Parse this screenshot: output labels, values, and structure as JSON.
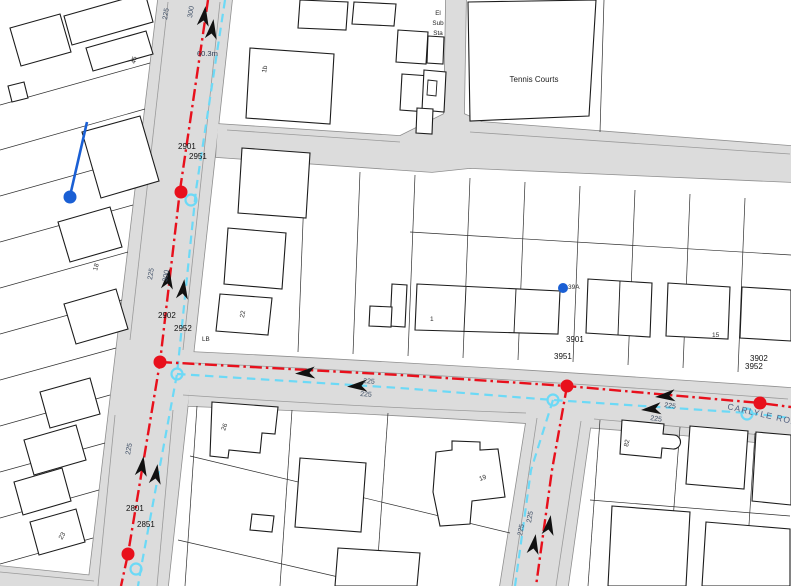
{
  "colors": {
    "main_red": "#e8101c",
    "secondary_cyan": "#6cd9f6",
    "service_blue": "#1a5fd4",
    "road_fill": "#dcdcdc",
    "road_edge": "#8f8f8f",
    "building_outline": "#1c1c1c",
    "arrow_black": "#111111",
    "id_label": "#111111",
    "size_label": "#3f4f66",
    "house_number": "#2e2e2e",
    "area_label": "#222222",
    "measurement_label": "#2e3c55",
    "road_name_label": "#4e5d7d"
  },
  "map": {
    "road_name": "CARLYLE ROAD",
    "measurement": "60.3m",
    "area_labels": {
      "tennis_courts": "Tennis Courts",
      "el": "El",
      "sub": "Sub",
      "sta": "Sta",
      "letter_box": "LB"
    },
    "main_ids": {
      "id_2901": "2901",
      "id_2951": "2951",
      "id_2902": "2902",
      "id_2952": "2952",
      "id_2801": "2801",
      "id_2851": "2851",
      "id_3901": "3901",
      "id_3951": "3951",
      "id_3902": "3902",
      "id_3952": "3952"
    },
    "pipe_sizes": {
      "s225": "225",
      "s300": "300"
    },
    "house_numbers": {
      "n45": "45",
      "n1b": "1b",
      "n18": "18",
      "n22": "22",
      "n26": "26",
      "n1": "1",
      "n15": "15",
      "n19": "19",
      "n82": "82",
      "n23": "23",
      "n39a": "39A"
    }
  }
}
